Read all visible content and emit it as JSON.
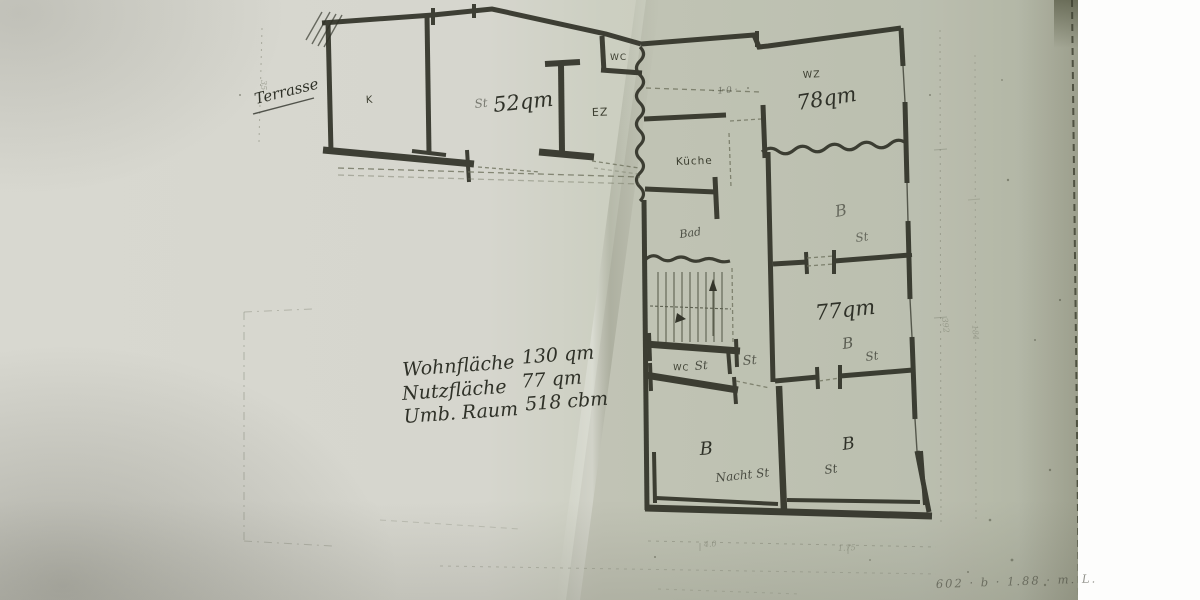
{
  "meta": {
    "description": "Photograph of a folded paper sheet with a hand-drawn architectural floor plan and handwritten area calculations",
    "paper_color": "#d7d7cf",
    "fold_side_color": "#c9ccbe",
    "ink_color": "#2e2f25",
    "page_edge_color": "#565a44"
  },
  "labels": {
    "terrasse": "Terrasse",
    "k": "K",
    "st52_prefix": "St",
    "area52": "52qm",
    "ez": "EZ",
    "wc_top": "WC",
    "wz": "WZ",
    "area78": "78qm",
    "kueche": "Küche",
    "bad": "Bad",
    "b_mid": "B",
    "st_mid": "St",
    "area77": "77qm",
    "b77": "B",
    "st77": "St",
    "wc_low": "WC",
    "st_wc": "St",
    "st_hall": "St",
    "b_bl": "B",
    "nacht_st": "Nacht St",
    "b_br": "B",
    "st_br": "St",
    "pencil_note": "· 1·0 ·"
  },
  "summary": {
    "rows": [
      {
        "label": "Wohnfläche",
        "value": "130 qm"
      },
      {
        "label": "Nutzfläche",
        "value": "77 qm"
      },
      {
        "label": "Umb. Raum",
        "value": "518 cbm"
      }
    ]
  },
  "dims": {
    "left_v": "35",
    "right_v1": "392",
    "right_v2": "184",
    "bottom_1": "4.0",
    "bottom_2": "1.75"
  },
  "footer_scribble": "602 · b · 1.88 · m. L."
}
